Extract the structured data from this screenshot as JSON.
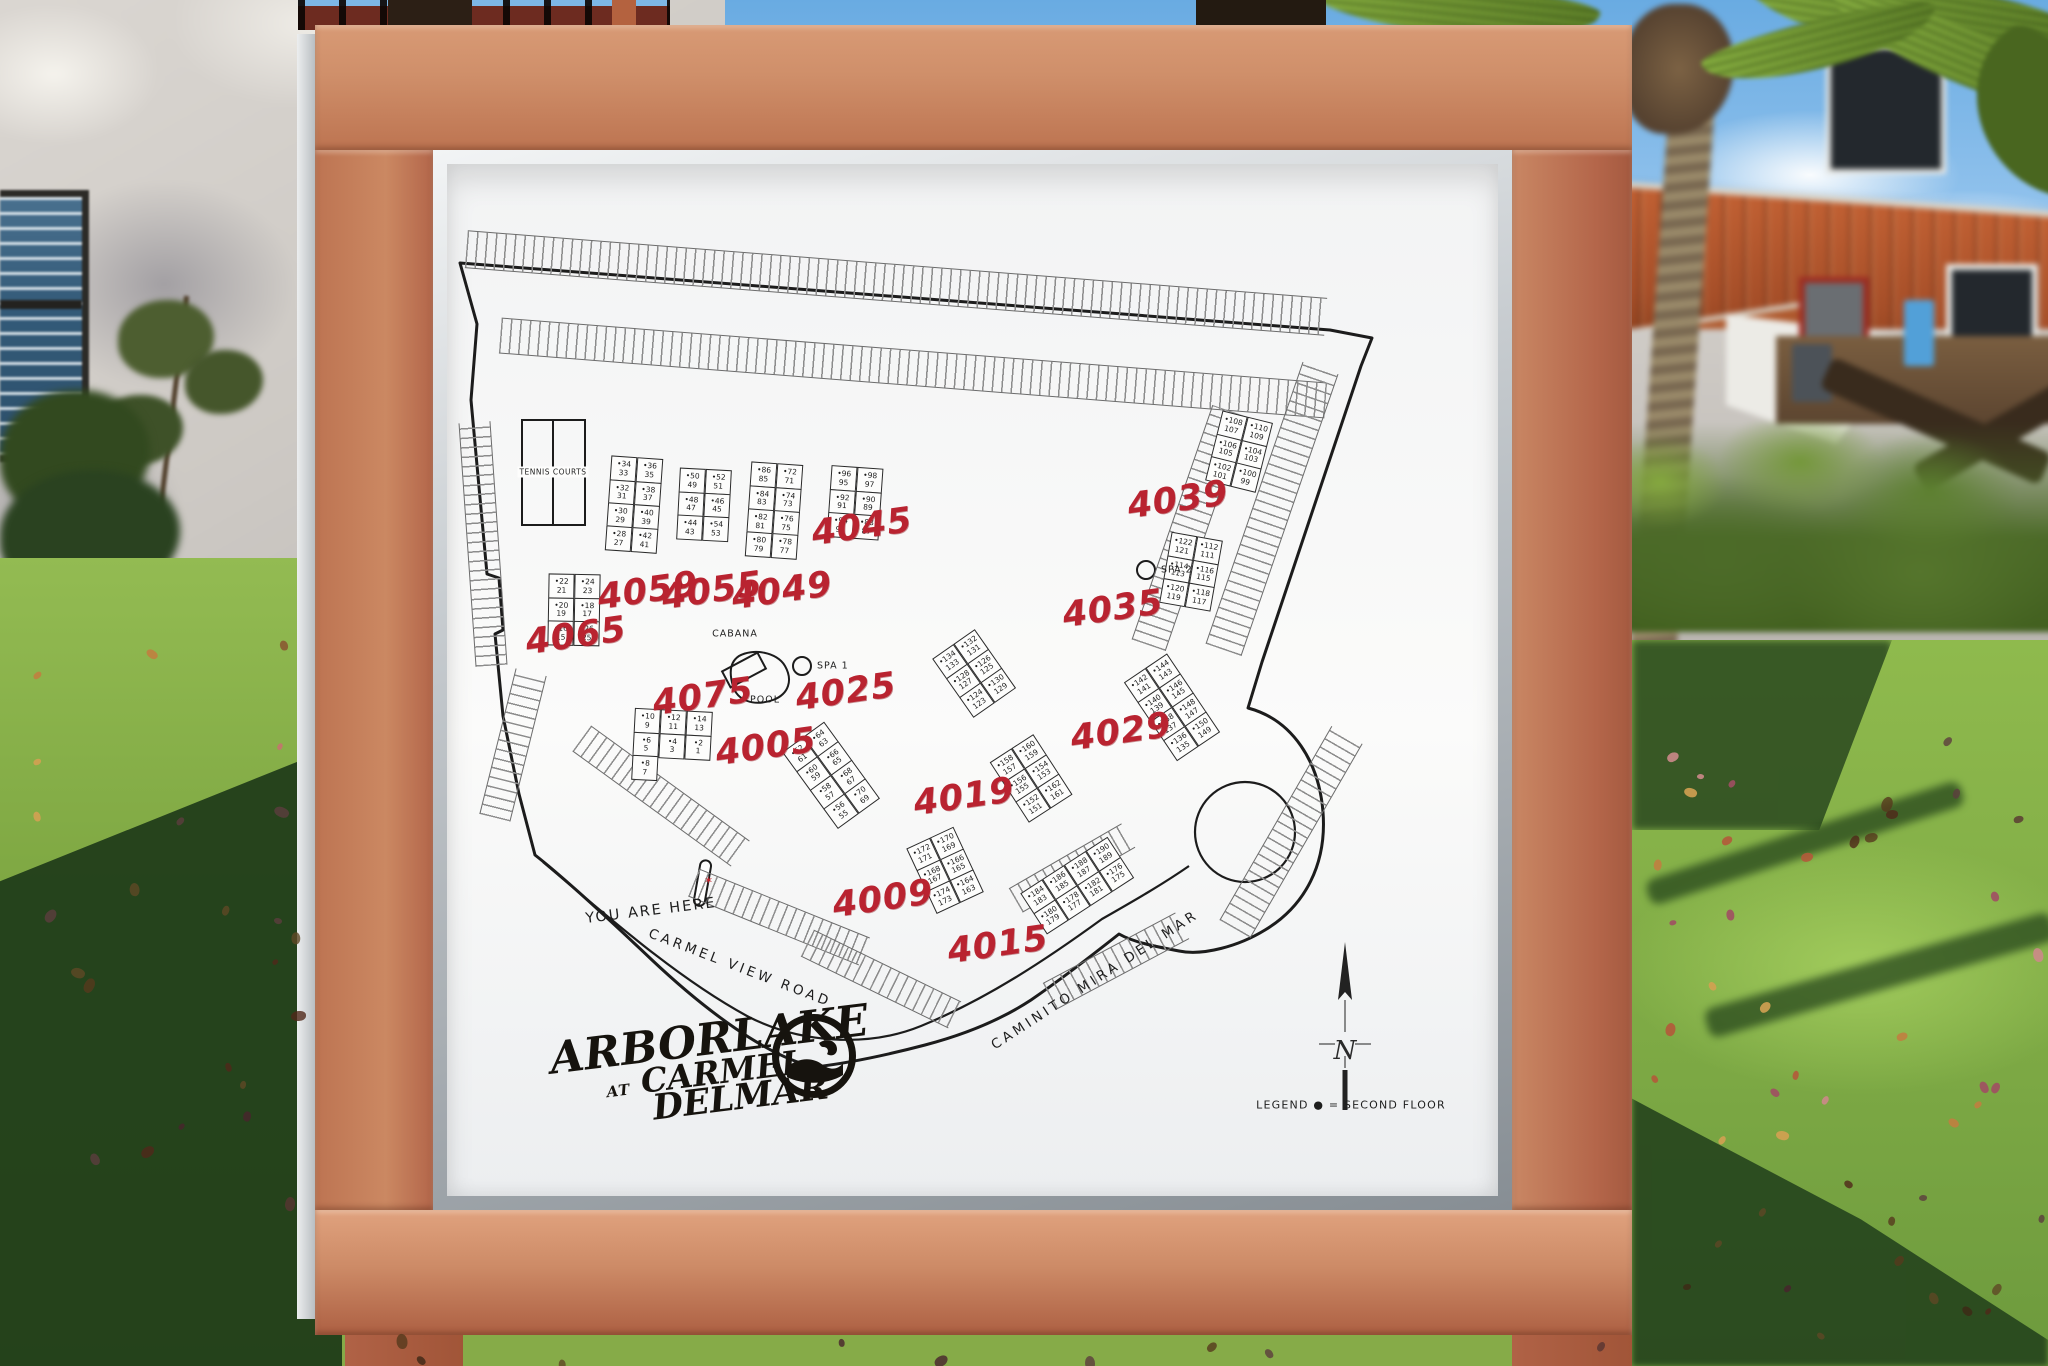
{
  "sign": {
    "map": {
      "tennis_courts_label": "TENNIS COURTS",
      "cabana_label": "CABANA",
      "pool_label": "POOL",
      "spa1_label": "SPA 1",
      "spa2_label": "SPA 2",
      "you_are_here_label": "YOU ARE HERE",
      "roads": {
        "carmel_view_road": "CARMEL VIEW ROAD",
        "caminito_mira_del_mar": "CAMINITO MIRA DEL MAR"
      },
      "north_label": "N",
      "legend_text": "LEGEND ● = SECOND FLOOR",
      "second_floor_marker": "•",
      "accent_red": "#b92330",
      "building_labels": [
        "4065",
        "4059",
        "4055",
        "4049",
        "4045",
        "4039",
        "4035",
        "4025",
        "4075",
        "4005",
        "4029",
        "4019",
        "4009",
        "4015"
      ],
      "clusters": [
        {
          "building": "4065",
          "units": [
            [
              "22",
              "21"
            ],
            [
              "24",
              "23"
            ],
            [
              "20",
              "19"
            ],
            [
              "18",
              "17"
            ],
            [
              "16",
              "15"
            ],
            [
              "26",
              "25"
            ]
          ]
        },
        {
          "building": "4059",
          "units": [
            [
              "34",
              "33"
            ],
            [
              "36",
              "35"
            ],
            [
              "32",
              "31"
            ],
            [
              "38",
              "37"
            ],
            [
              "30",
              "29"
            ],
            [
              "40",
              "39"
            ],
            [
              "28",
              "27"
            ],
            [
              "42",
              "41"
            ]
          ]
        },
        {
          "building": "4055",
          "units": [
            [
              "50",
              "49"
            ],
            [
              "52",
              "51"
            ],
            [
              "48",
              "47"
            ],
            [
              "46",
              "45"
            ],
            [
              "44",
              "43"
            ],
            [
              "54",
              "53"
            ]
          ]
        },
        {
          "building": "4049",
          "units": [
            [
              "86",
              "85"
            ],
            [
              "72",
              "71"
            ],
            [
              "84",
              "83"
            ],
            [
              "74",
              "73"
            ],
            [
              "82",
              "81"
            ],
            [
              "76",
              "75"
            ],
            [
              "80",
              "79"
            ],
            [
              "78",
              "77"
            ]
          ]
        },
        {
          "building": "4045",
          "units": [
            [
              "96",
              "95"
            ],
            [
              "98",
              "97"
            ],
            [
              "92",
              "91"
            ],
            [
              "90",
              "89"
            ],
            [
              "94",
              "93"
            ],
            [
              "88",
              "87"
            ]
          ]
        },
        {
          "building": "4039",
          "units": [
            [
              "108",
              "107"
            ],
            [
              "110",
              "109"
            ],
            [
              "106",
              "105"
            ],
            [
              "104",
              "103"
            ],
            [
              "102",
              "101"
            ],
            [
              "100",
              "99"
            ]
          ]
        },
        {
          "building": "4035",
          "units": [
            [
              "122",
              "121"
            ],
            [
              "112",
              "111"
            ],
            [
              "114",
              "113"
            ],
            [
              "116",
              "115"
            ],
            [
              "120",
              "119"
            ],
            [
              "118",
              "117"
            ]
          ]
        },
        {
          "building": "4025",
          "units": [
            [
              "134",
              "133"
            ],
            [
              "132",
              "131"
            ],
            [
              "128",
              "127"
            ],
            [
              "126",
              "125"
            ],
            [
              "124",
              "123"
            ],
            [
              "130",
              "129"
            ]
          ]
        },
        {
          "building": "4029",
          "units": [
            [
              "142",
              "141"
            ],
            [
              "144",
              "143"
            ],
            [
              "140",
              "139"
            ],
            [
              "146",
              "145"
            ],
            [
              "138",
              "137"
            ],
            [
              "148",
              "147"
            ],
            [
              "136",
              "135"
            ],
            [
              "150",
              "149"
            ]
          ]
        },
        {
          "building": "4075",
          "units": [
            [
              "10",
              "9"
            ],
            [
              "12",
              "11"
            ],
            [
              "14",
              "13"
            ],
            [
              "6",
              "5"
            ],
            [
              "4",
              "3"
            ],
            [
              "2",
              "1"
            ],
            [
              "8",
              "7"
            ]
          ]
        },
        {
          "building": "4005",
          "units": [
            [
              "62",
              "61"
            ],
            [
              "64",
              "63"
            ],
            [
              "60",
              "59"
            ],
            [
              "66",
              "65"
            ],
            [
              "58",
              "57"
            ],
            [
              "68",
              "67"
            ],
            [
              "56",
              "55"
            ],
            [
              "70",
              "69"
            ]
          ]
        },
        {
          "building": "4019",
          "units": [
            [
              "158",
              "157"
            ],
            [
              "160",
              "159"
            ],
            [
              "156",
              "155"
            ],
            [
              "154",
              "153"
            ],
            [
              "152",
              "151"
            ],
            [
              "162",
              "161"
            ]
          ]
        },
        {
          "building": "4009",
          "units": [
            [
              "172",
              "171"
            ],
            [
              "170",
              "169"
            ],
            [
              "168",
              "167"
            ],
            [
              "166",
              "165"
            ],
            [
              "174",
              "173"
            ],
            [
              "164",
              "163"
            ]
          ]
        },
        {
          "building": "4015",
          "units": [
            [
              "184",
              "183"
            ],
            [
              "186",
              "185"
            ],
            [
              "188",
              "187"
            ],
            [
              "190",
              "189"
            ],
            [
              "180",
              "179"
            ],
            [
              "178",
              "177"
            ],
            [
              "182",
              "181"
            ],
            [
              "176",
              "175"
            ]
          ]
        }
      ]
    },
    "logo": {
      "line1": "ARBORLAKE",
      "line2_small": "AT",
      "line2": "CARMEL",
      "line3": "DELMAR"
    }
  }
}
